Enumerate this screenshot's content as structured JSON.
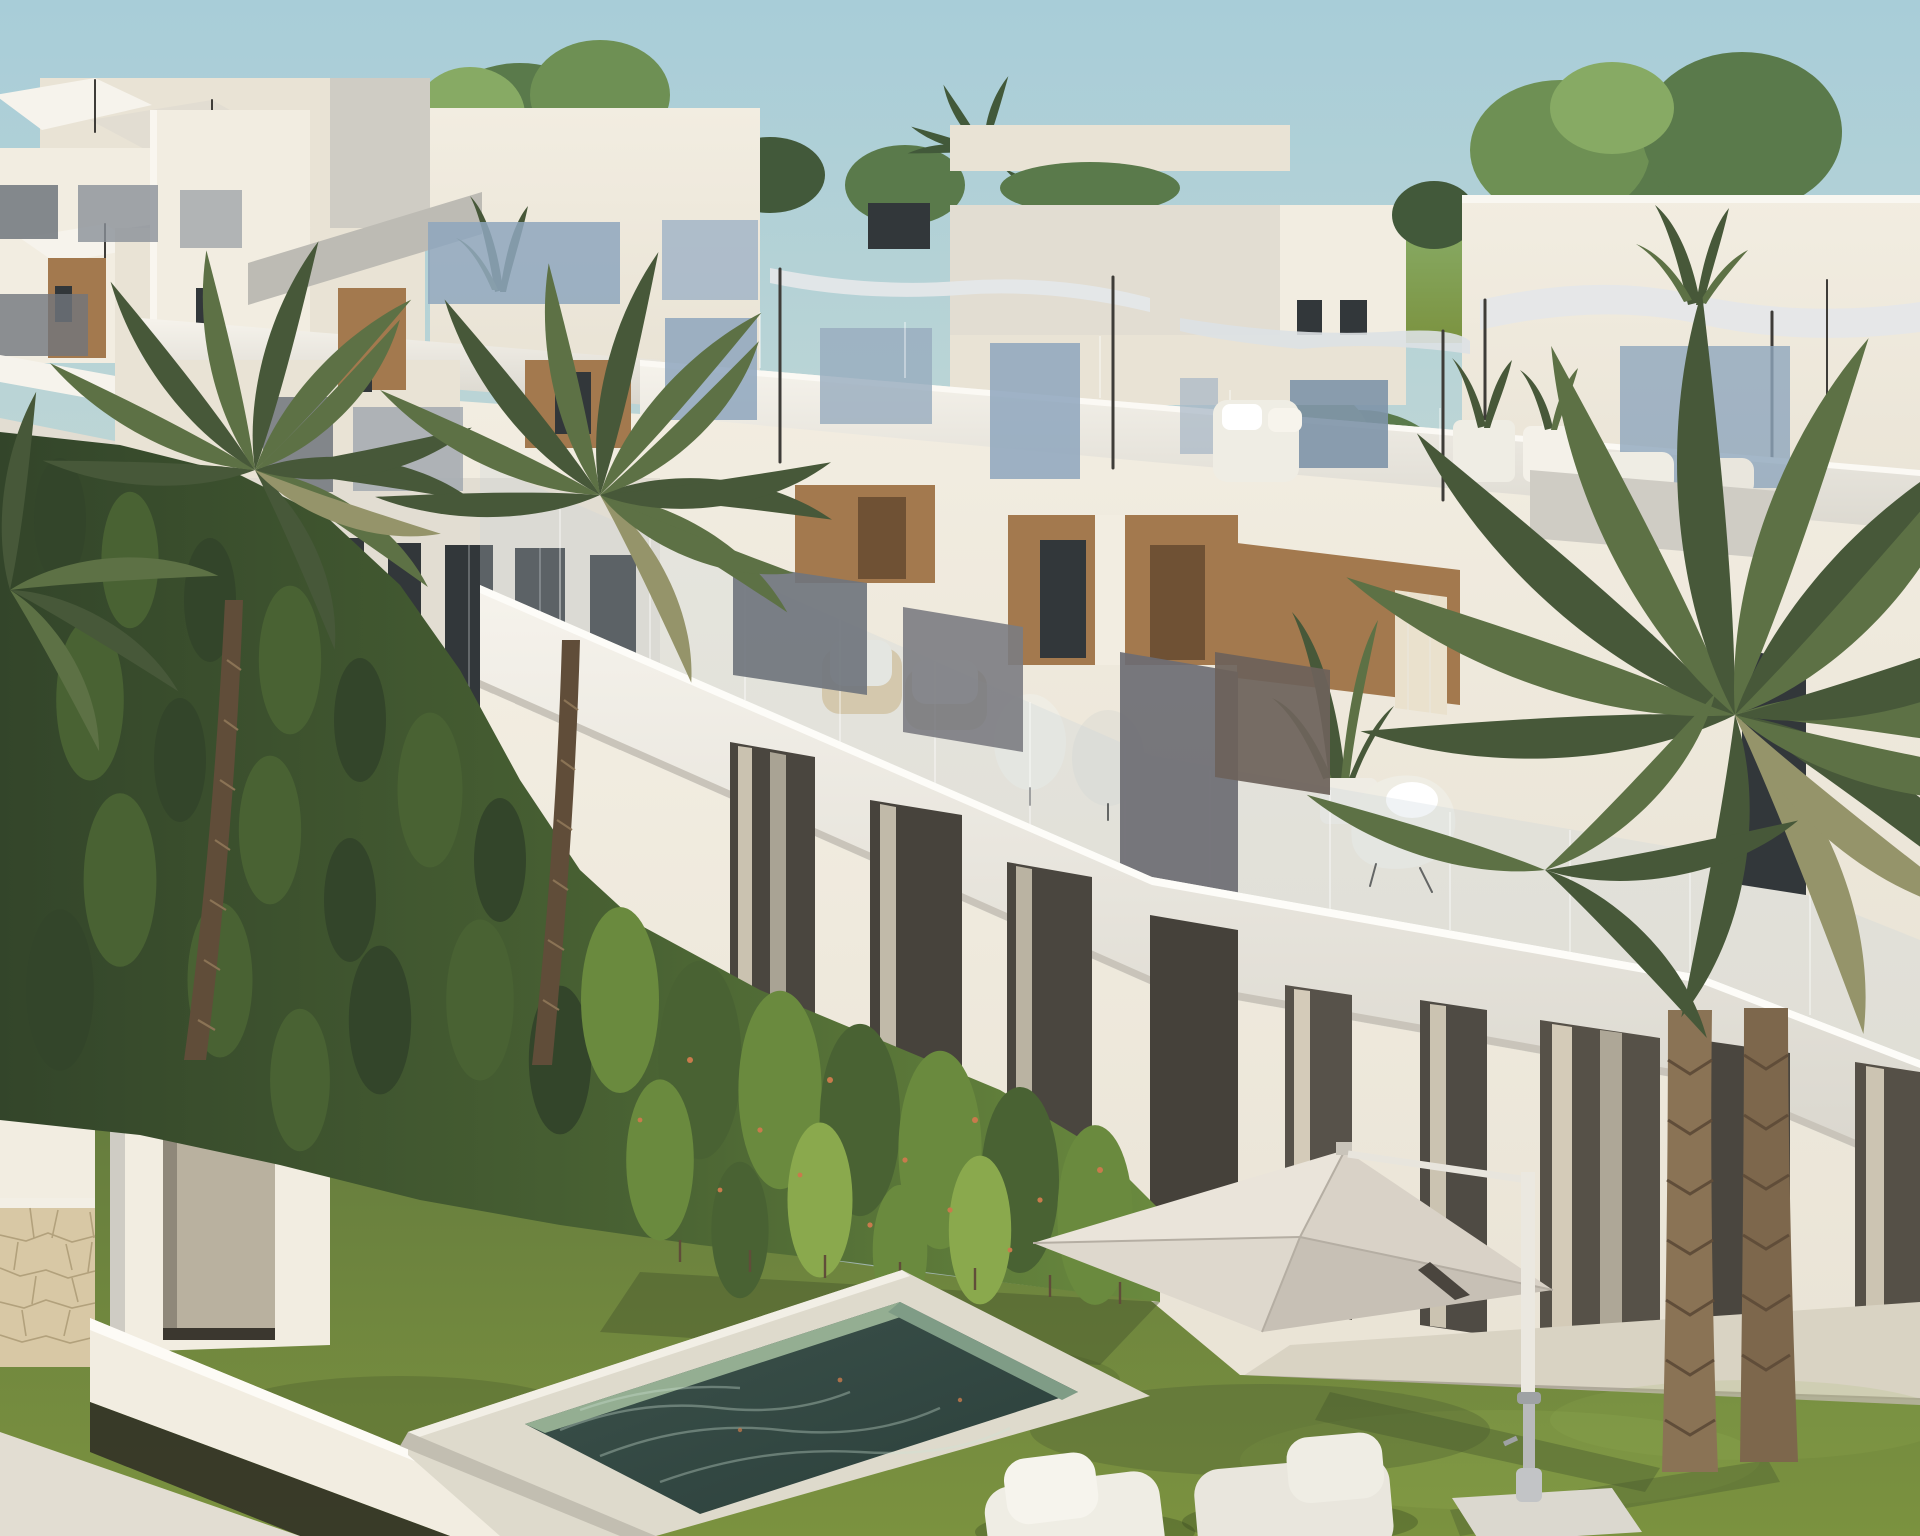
{
  "meta": {
    "title": "Modern townhouse development – exterior 3D render",
    "type": "architectural-visualization",
    "view": "elevated three-quarter view along a row of white townhouses at golden hour",
    "contains_text": false
  },
  "palette": {
    "sky-top": "#a8cdd8",
    "sky-low": "#cddcd3",
    "tree-deep": "#42593a",
    "tree-mid": "#5a7a4b",
    "tree-soft": "#6e9054",
    "tree-glow": "#87aa64",
    "wall-lit": "#f2ede1",
    "wall-base": "#e9e3d5",
    "wall-neutral": "#e2ddd2",
    "wall-shade": "#cfccc4",
    "wall-gray": "#bdbbb4",
    "band-lit": "#f6f3ec",
    "band-shade": "#d9d6cd",
    "wood": "#a3794e",
    "wood-deep": "#6f5134",
    "window": "#32373a",
    "curtain": "#eae1cd",
    "glass-blue": "#8ea6bd",
    "glass-smoke": "#70757d",
    "glass-brown": "#6d625a",
    "glass-clear": "#c9d4da",
    "hedge-deep": "#33452a",
    "hedge-mid": "#496233",
    "hedge-lit": "#6a8a3e",
    "hedge-tip": "#8aa94d",
    "berry": "#c97a4c",
    "grass": "#667d3e",
    "grass-lit": "#7b923f",
    "grass-dk": "#46572d",
    "deck": "#dedacc",
    "deck-shade": "#c2beb1",
    "water-rim": "#94ae92",
    "water": "#3c524b",
    "water-deep": "#2b3f3b",
    "umb-lit": "#eae4da",
    "umb-mid": "#d9d2c7",
    "umb-dark": "#c7c0b5",
    "lounger": "#efede4",
    "palm": "#5d7145",
    "palm-dk": "#475839",
    "palm-dry": "#95946a",
    "trunk": "#8a7355",
    "trunk-dk": "#604d39",
    "stone": "#d8c8a5",
    "stone-ln": "#b2a17c",
    "patio": "#d9d3c3",
    "sail": "#e4e7e9",
    "post": "#3e3c38",
    "shadow": "#2e2b25"
  },
  "scene": {
    "objects": [
      {
        "name": "sky",
        "description": "clear pale blue evening sky"
      },
      {
        "name": "background-treeline",
        "description": "dense mediterranean trees and palms behind the development"
      },
      {
        "name": "golf-gap",
        "description": "narrow gap between buildings revealing sunlit lawn"
      },
      {
        "name": "left-building-cluster",
        "description": "stepped white villas with rooftop shade sails"
      },
      {
        "name": "townhouse-row",
        "description": "long stepped row of two-storey white townhouses receding diagonally"
      },
      {
        "name": "roof-terraces",
        "description": "roof terraces with tinted glass balustrades, sails, plants and loungers"
      },
      {
        "name": "shade-sails",
        "description": "light tensile shade canopies on slim dark posts"
      },
      {
        "name": "glass-balustrades",
        "description": "frameless clear glass rails along terrace slabs"
      },
      {
        "name": "privacy-glass-panels",
        "description": "smoked glass dividers between terraces"
      },
      {
        "name": "wood-clad-recesses",
        "description": "warm timber cladding around terrace doorways"
      },
      {
        "name": "terrace-furniture",
        "description": "wicker armchairs, egg chairs and a white chaise with plants"
      },
      {
        "name": "garden-hedge",
        "description": "tall cypress hedge, shaded at left, sunlit at right, with tiny orange blossoms"
      },
      {
        "name": "left-palm-trees",
        "description": "two tall palms rising from the hedge plus corner fronds"
      },
      {
        "name": "right-palm-trees",
        "description": "large twin-trunk palm in the foreground garden"
      },
      {
        "name": "boundary-walls",
        "description": "white capped garden walls stepping downhill"
      },
      {
        "name": "stone-wall",
        "description": "natural stone clad wall section at lower left"
      },
      {
        "name": "garden-gate",
        "description": "white gate volume with recessed beige door"
      },
      {
        "name": "lawn",
        "description": "manicured garden lawn with long evening shadows"
      },
      {
        "name": "plunge-pool",
        "description": "rectangular pool with green natural-stone interior and white coping"
      },
      {
        "name": "pool-deck",
        "description": "raised white stone deck around the pool"
      },
      {
        "name": "cantilever-umbrella",
        "description": "square cream cantilever parasol on white mast with base plate"
      },
      {
        "name": "lounge-chairs",
        "description": "two white boucle loungers at the pool edge"
      },
      {
        "name": "rear-patio",
        "description": "beige terrace slab along the near house with curtained sliding doors"
      }
    ]
  }
}
